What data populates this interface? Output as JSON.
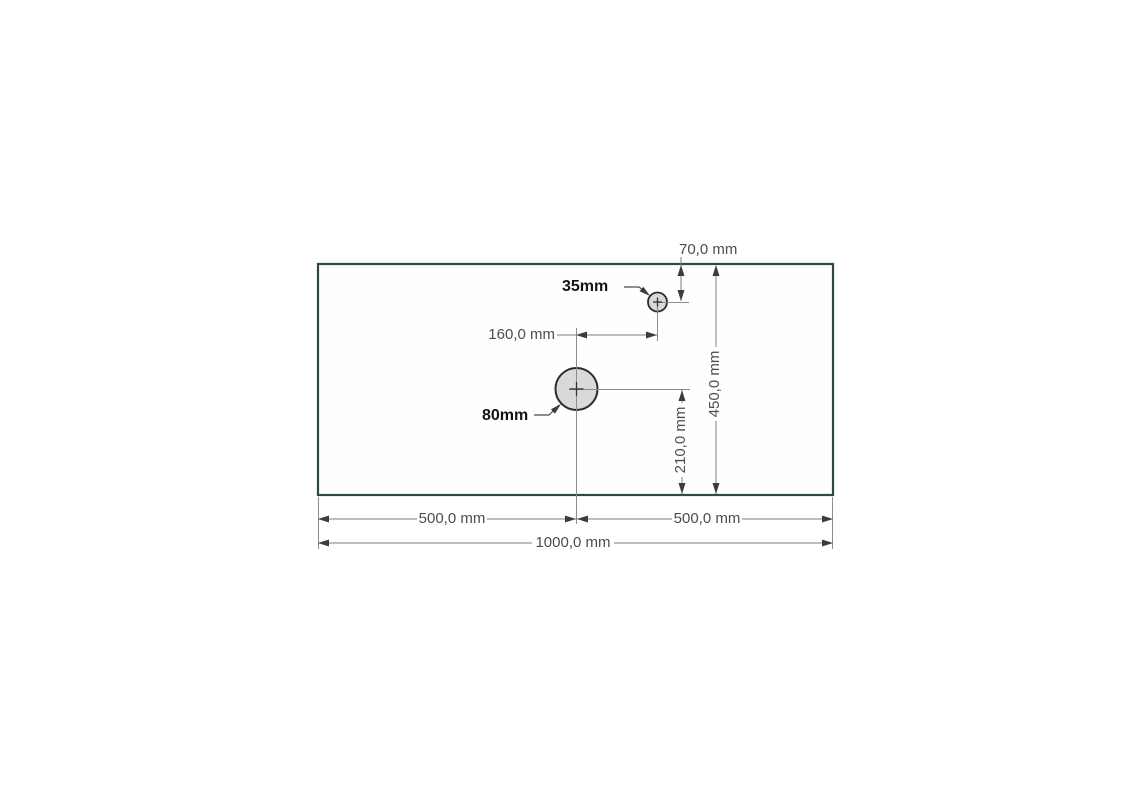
{
  "drawing": {
    "plate": {
      "width_label": "1000,0 mm",
      "left_half_label": "500,0 mm",
      "right_half_label": "500,0 mm",
      "height_label": "450,0 mm"
    },
    "large_hole": {
      "diameter_label": "80mm",
      "offset_bottom_label": "210,0 mm"
    },
    "small_hole": {
      "diameter_label": "35mm",
      "offset_top_label": "70,0 mm",
      "offset_from_center_label": "160,0 mm"
    },
    "colors": {
      "background": "#ffffff",
      "plate_outline": "#2e4a41",
      "dimension_line": "#7d7d7d",
      "arrowhead": "#3c3c3c",
      "dimension_text": "#4d4d4d",
      "label_text": "#141414",
      "hole_fill": "#d9d9d9",
      "hole_outline": "#2b2b2b"
    }
  }
}
